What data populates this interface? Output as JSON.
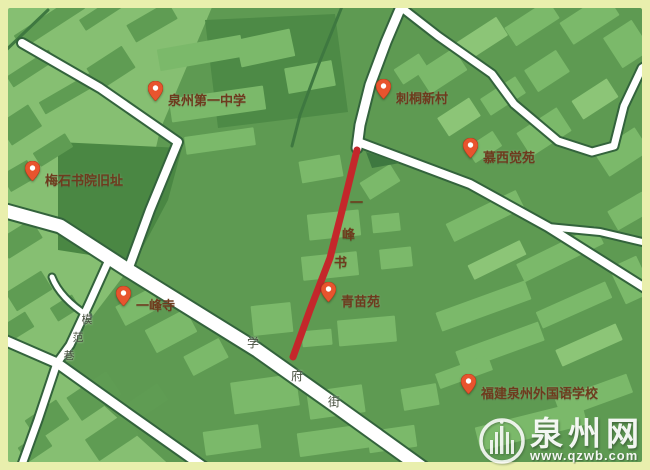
{
  "window": {
    "width": 650,
    "height": 470
  },
  "map": {
    "pois": [
      {
        "id": "quanzhou-no1-middle-school",
        "label": "泉州第一中学"
      },
      {
        "id": "citong-xincun",
        "label": "刺桐新村"
      },
      {
        "id": "muxi-jueyuan",
        "label": "慕西觉苑"
      },
      {
        "id": "meishi-academy-site",
        "label": "梅石书院旧址"
      },
      {
        "id": "yifeng-temple",
        "label": "一峰寺"
      },
      {
        "id": "qingmiao-yuan",
        "label": "青苗苑"
      },
      {
        "id": "fujian-quanzhou-foreign-language-school",
        "label": "福建泉州外国语学校"
      }
    ],
    "roads": {
      "closed_road_name": "一峰书",
      "closed_road_chars": [
        "一",
        "峰",
        "书"
      ],
      "xuefu_street_chars": [
        "学",
        "府",
        "街"
      ],
      "mofan_lane_chars": [
        "模",
        "范",
        "巷"
      ]
    },
    "colors": {
      "frame": "#e9efad",
      "map_base": "#5e9a52",
      "light_zone": "#86bf72",
      "dark_zone": "#4d8a46",
      "building_light": "#7bb96a",
      "road_white": "#ffffff",
      "road_casing": "#33633c",
      "closed_road_red": "#c4272b",
      "pin_orange": "#e8542e",
      "poi_label_color": "#6e3b1d"
    },
    "watermark": {
      "site_name": "泉州网",
      "site_url": "www.qzwb.com"
    }
  }
}
